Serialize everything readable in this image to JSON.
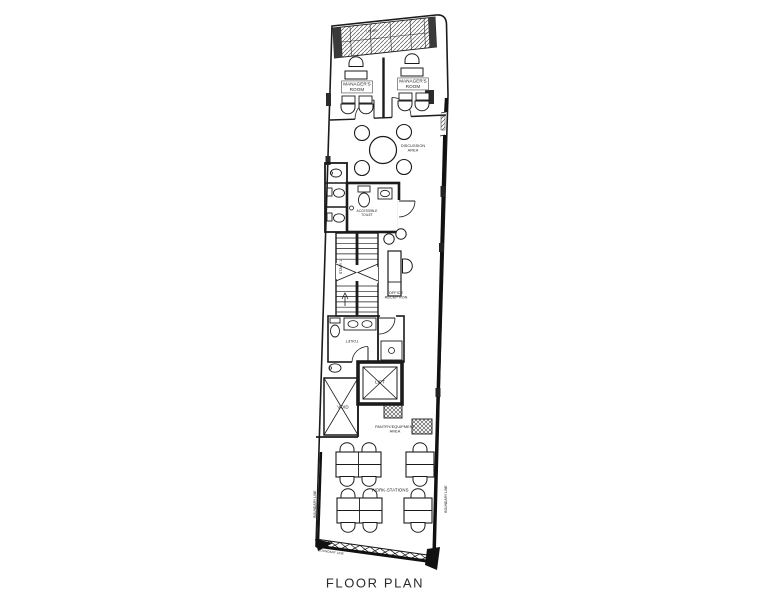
{
  "page": {
    "title": "FLOOR PLAN"
  },
  "plan": {
    "areas": {
      "ledge": "LEDGE",
      "managers_room_left": "MANAGER'S\nROOM",
      "managers_room_right": "MANAGER'S\nROOM",
      "discussion_area": "DISCUSSION\nAREA",
      "accessible_toilet": "ACCESSIBLE\nTOILET",
      "stair_1": "STAIR 1",
      "office_reception": "OFFICE\nRECEPTION",
      "toilet": "TOILET",
      "lift": "LIFT",
      "void": "VOID",
      "pantry_equipment_area": "PANTRY/EQUIPMENT\nAREA",
      "work_stations": "WORK-STATIONS"
    },
    "boundaries": {
      "left": "BOUNDARY LINE",
      "right": "BOUNDARY LINE",
      "bottom": "BOUNDARY LINE"
    }
  },
  "colors": {
    "ink": "#1b1b1b",
    "wall": "#333333",
    "paper": "#ffffff"
  }
}
